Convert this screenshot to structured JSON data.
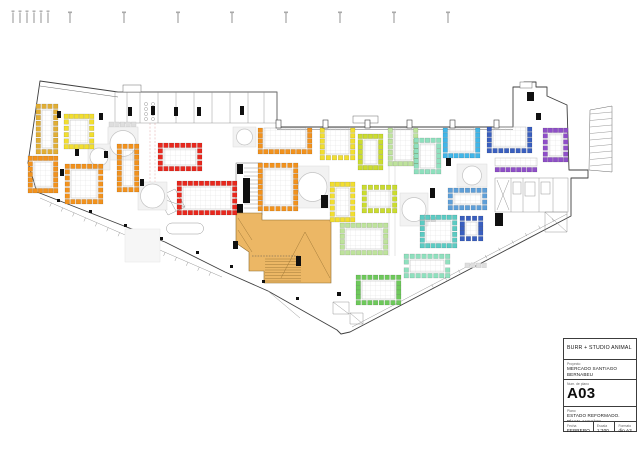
{
  "title_block": {
    "studio": "BURR + STUDIO ANIMAL",
    "project_label": "Proyecto",
    "project": "MERCADO SANTIAGO BERNABEU",
    "number_label": "Num. de plano",
    "number": "A03",
    "plan_label": "Plano",
    "plan_title": "ESTADO REFORMADO. Planta completa",
    "date_label": "Fecha",
    "date": "FEBRERO 2024",
    "scale_label": "Escala",
    "scale": "1:300",
    "format_label": "Formato",
    "format": "din A3"
  },
  "colors": {
    "gold": "#e1ae35",
    "yellow": "#f2de30",
    "orange": "#f2921d",
    "red": "#e8281e",
    "chartreuse": "#cbdc2f",
    "palegreen": "#bee39c",
    "green": "#6ec95b",
    "mint": "#8fe0be",
    "teal": "#5ccbc3",
    "cyan": "#41b6e8",
    "blue": "#3a5fbf",
    "lightblue": "#5f9fd8",
    "purple": "#8f4fc8",
    "platform_tan": "#ecb765"
  },
  "plan": {
    "clusters": [
      {
        "x": 36,
        "y": 104,
        "w": 22,
        "h": 50,
        "color": "gold",
        "sides": "trbl"
      },
      {
        "x": 64,
        "y": 114,
        "w": 30,
        "h": 35,
        "color": "yellow",
        "sides": "trbl"
      },
      {
        "x": 28,
        "y": 156,
        "w": 30,
        "h": 37,
        "color": "orange",
        "sides": "trbl"
      },
      {
        "x": 65,
        "y": 164,
        "w": 38,
        "h": 40,
        "color": "orange",
        "sides": "trbl"
      },
      {
        "x": 117,
        "y": 144,
        "w": 22,
        "h": 48,
        "color": "orange",
        "sides": "trbl"
      },
      {
        "x": 158,
        "y": 143,
        "w": 44,
        "h": 28,
        "color": "red",
        "sides": "trbl"
      },
      {
        "x": 177,
        "y": 181,
        "w": 60,
        "h": 34,
        "color": "red",
        "sides": "trbl"
      },
      {
        "x": 258,
        "y": 163,
        "w": 40,
        "h": 48,
        "color": "orange",
        "sides": "trbl"
      },
      {
        "x": 258,
        "y": 128,
        "w": 54,
        "h": 26,
        "color": "orange",
        "sides": "rbl"
      },
      {
        "x": 320,
        "y": 128,
        "w": 35,
        "h": 32,
        "color": "yellow",
        "sides": "rbl"
      },
      {
        "x": 358,
        "y": 134,
        "w": 25,
        "h": 36,
        "color": "chartreuse",
        "sides": "trbl"
      },
      {
        "x": 388,
        "y": 128,
        "w": 30,
        "h": 38,
        "color": "palegreen",
        "sides": "rbl"
      },
      {
        "x": 414,
        "y": 138,
        "w": 27,
        "h": 36,
        "color": "mint",
        "sides": "trbl"
      },
      {
        "x": 443,
        "y": 128,
        "w": 37,
        "h": 30,
        "color": "cyan",
        "sides": "rbl"
      },
      {
        "x": 487,
        "y": 127,
        "w": 45,
        "h": 26,
        "color": "blue",
        "sides": "rbl"
      },
      {
        "x": 543,
        "y": 128,
        "w": 25,
        "h": 34,
        "color": "purple",
        "sides": "trbl"
      },
      {
        "x": 495,
        "y": 158,
        "w": 42,
        "h": 14,
        "color": "purple",
        "sides": "b"
      },
      {
        "x": 330,
        "y": 182,
        "w": 25,
        "h": 40,
        "color": "yellow",
        "sides": "trbl"
      },
      {
        "x": 362,
        "y": 185,
        "w": 35,
        "h": 28,
        "color": "chartreuse",
        "sides": "trbl"
      },
      {
        "x": 448,
        "y": 188,
        "w": 39,
        "h": 22,
        "color": "lightblue",
        "sides": "trbl"
      },
      {
        "x": 340,
        "y": 223,
        "w": 48,
        "h": 32,
        "color": "palegreen",
        "sides": "trbl"
      },
      {
        "x": 420,
        "y": 215,
        "w": 37,
        "h": 33,
        "color": "teal",
        "sides": "trbl"
      },
      {
        "x": 460,
        "y": 216,
        "w": 23,
        "h": 25,
        "color": "blue",
        "sides": "trbl"
      },
      {
        "x": 356,
        "y": 275,
        "w": 45,
        "h": 30,
        "color": "green",
        "sides": "trbl"
      },
      {
        "x": 404,
        "y": 254,
        "w": 46,
        "h": 24,
        "color": "mint",
        "sides": "trbl"
      }
    ],
    "tables": [
      {
        "x": 108,
        "y": 127,
        "w": 30,
        "h": 33,
        "grayTop": true
      },
      {
        "x": 88,
        "y": 144,
        "w": 22,
        "h": 26
      },
      {
        "x": 138,
        "y": 182,
        "w": 29,
        "h": 28
      },
      {
        "x": 233,
        "y": 127,
        "w": 23,
        "h": 20
      },
      {
        "x": 296,
        "y": 166,
        "w": 33,
        "h": 42
      },
      {
        "x": 400,
        "y": 193,
        "w": 28,
        "h": 33
      },
      {
        "x": 457,
        "y": 164,
        "w": 30,
        "h": 23
      }
    ],
    "gray_rows": [
      {
        "x": 465,
        "y": 263,
        "w": 26
      },
      {
        "x": 420,
        "y": 217,
        "w": 18
      }
    ],
    "light_zones": [
      {
        "x": 108,
        "y": 128,
        "w": 30,
        "h": 31
      },
      {
        "x": 125,
        "y": 229,
        "w": 35,
        "h": 33
      }
    ],
    "black_marks": [
      [
        57,
        111,
        4,
        7
      ],
      [
        99,
        113,
        4,
        7
      ],
      [
        128,
        107,
        4,
        9
      ],
      [
        151,
        106,
        4,
        9
      ],
      [
        174,
        107,
        4,
        9
      ],
      [
        197,
        107,
        4,
        9
      ],
      [
        240,
        106,
        4,
        9
      ],
      [
        75,
        149,
        4,
        7
      ],
      [
        104,
        151,
        4,
        7
      ],
      [
        60,
        169,
        4,
        7
      ],
      [
        140,
        179,
        4,
        7
      ],
      [
        57,
        199,
        3,
        3
      ],
      [
        89,
        210,
        3,
        3
      ],
      [
        124,
        224,
        3,
        3
      ],
      [
        160,
        237,
        3,
        3
      ],
      [
        196,
        251,
        3,
        3
      ],
      [
        230,
        265,
        3,
        3
      ],
      [
        262,
        280,
        3,
        3
      ],
      [
        296,
        297,
        3,
        3
      ],
      [
        337,
        292,
        4,
        4
      ],
      [
        243,
        178,
        7,
        25
      ],
      [
        321,
        195,
        7,
        13
      ],
      [
        296,
        256,
        5,
        10
      ],
      [
        233,
        241,
        5,
        8
      ],
      [
        527,
        92,
        7,
        9
      ],
      [
        536,
        113,
        5,
        7
      ],
      [
        446,
        158,
        5,
        8
      ],
      [
        430,
        188,
        5,
        10
      ],
      [
        495,
        213,
        8,
        13
      ]
    ],
    "door_ticks_x": [
      276,
      323,
      365,
      407,
      450,
      494
    ],
    "top_ticks_x": [
      70,
      124,
      178,
      232,
      286,
      340,
      394,
      448
    ],
    "scale_bar_x": [
      13,
      20,
      27,
      34,
      41,
      48
    ],
    "band": {
      "x": 115,
      "y": 92,
      "w": 162,
      "h": 31,
      "dividers": [
        127,
        140,
        158,
        176,
        194,
        212,
        230,
        248,
        264
      ],
      "circles": [
        [
          146,
          104
        ],
        [
          153,
          104
        ],
        [
          146,
          109
        ],
        [
          153,
          109
        ],
        [
          146,
          114
        ],
        [
          153,
          114
        ],
        [
          146,
          119
        ],
        [
          153,
          119
        ]
      ]
    },
    "rooms_right": {
      "x": 495,
      "y": 178,
      "w": 73,
      "h": 34,
      "dividers": [
        511,
        523,
        539,
        553
      ]
    },
    "stair_block": {
      "x": 236,
      "y": 163,
      "w": 26,
      "h": 52
    },
    "hatch_triangle": {
      "pts": "590,110 612,106 612,172 589,170"
    },
    "paths": [
      {
        "cls": "wall",
        "d": "M40,81 L118,92 L277,92 L277,127 L513,127 L513,87 L524,87 L524,82 L536,82 L536,87 L547,87 L547,96 L567,105 L569,170 L588,170 L588,178 L571,178 L571,216 L350,332 L341,334 L337,330 L268,291 L225,272 L165,242 L37,192 L28,163 Z"
      },
      {
        "cls": "wall2",
        "d": "M277,129.5 L513,129.5"
      },
      {
        "cls": "wall2",
        "d": "M40,86 L118,97"
      },
      {
        "cls": "thin",
        "d": "M40,198 L222,277"
      },
      {
        "cls": "thin",
        "d": "M567,214 L352,327"
      },
      {
        "cls": "thin",
        "d": "M268,291 L300,318"
      },
      {
        "cls": "faint",
        "d": "M389,130 L389,256 M395,130 L395,256"
      },
      {
        "cls": "dashpink",
        "d": "M150,123 L150,196 M155,123 L155,196"
      },
      {
        "cls": "thin",
        "d": "M333,302 h16 v12 h-16 Z M333,302 l16,12 M350,313 h13 v11 h-13 Z M350,313 l13,11"
      },
      {
        "cls": "thin",
        "d": "M545,212 h22 v20 h-22 Z M545,212 l22,20"
      },
      {
        "cls": "thin",
        "d": "M172,223 h26 a5,5 0 0 1 0,11 h-26 a5,5 0 0 1 0,-11 Z"
      },
      {
        "cls": "thin",
        "d": "M158,197 l17,-8 l10,18 l-17,8 Z M158,197 l27,10 M166,193 l10,18"
      }
    ],
    "platform": {
      "outline": "M236,213 L262,213 L262,220 L331,220 L331,283 L264,283 L264,271 L249,271 L249,252 L236,243 Z",
      "steps_x1": 265,
      "steps_x2": 301,
      "steps_y1": 259,
      "steps_y2": 281,
      "steps_n": 9,
      "detail": "M305,232 L330,278 M305,232 L281,278 M238,218 L252,240 M238,230 L252,252",
      "zigzag": "M252,256 L300,256"
    },
    "tick_lines": [
      {
        "x1": 40,
        "y1": 198,
        "x2": 222,
        "y2": 277,
        "n": 16,
        "len": 4
      },
      {
        "x1": 567,
        "y1": 214,
        "x2": 420,
        "y2": 295,
        "n": 11,
        "len": 3.5
      }
    ]
  }
}
